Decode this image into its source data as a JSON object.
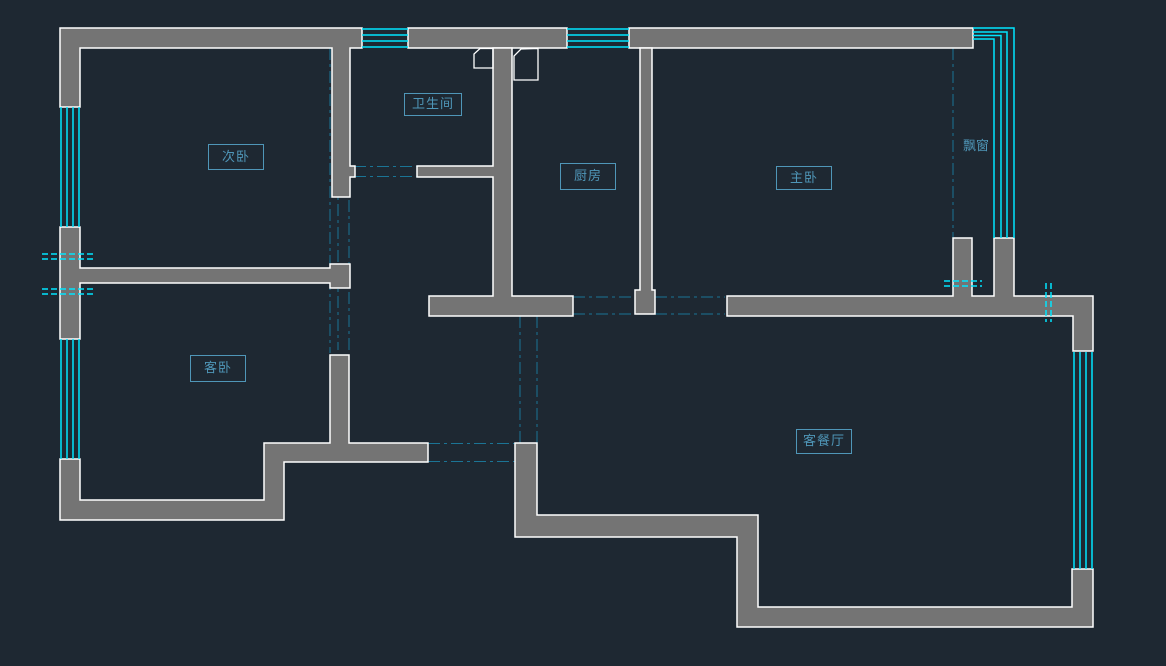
{
  "drawing": {
    "type": "cad-floor-plan",
    "rooms": {
      "secondary_bedroom": {
        "label": "次卧"
      },
      "bathroom": {
        "label": "卫生间"
      },
      "kitchen": {
        "label": "厨房"
      },
      "master_bedroom": {
        "label": "主卧"
      },
      "guest_bedroom": {
        "label": "客卧"
      },
      "living_dining": {
        "label": "客餐厅"
      },
      "bay_window": {
        "label": "飘窗"
      }
    },
    "colors": {
      "background": "#1e2832",
      "wall_fill": "#747474",
      "wall_outline": "#ffffff",
      "window_line": "#00e5ff",
      "opening_line": "#1b7495",
      "break_mark": "#00e5ff",
      "label_text": "#4f96b8"
    }
  }
}
